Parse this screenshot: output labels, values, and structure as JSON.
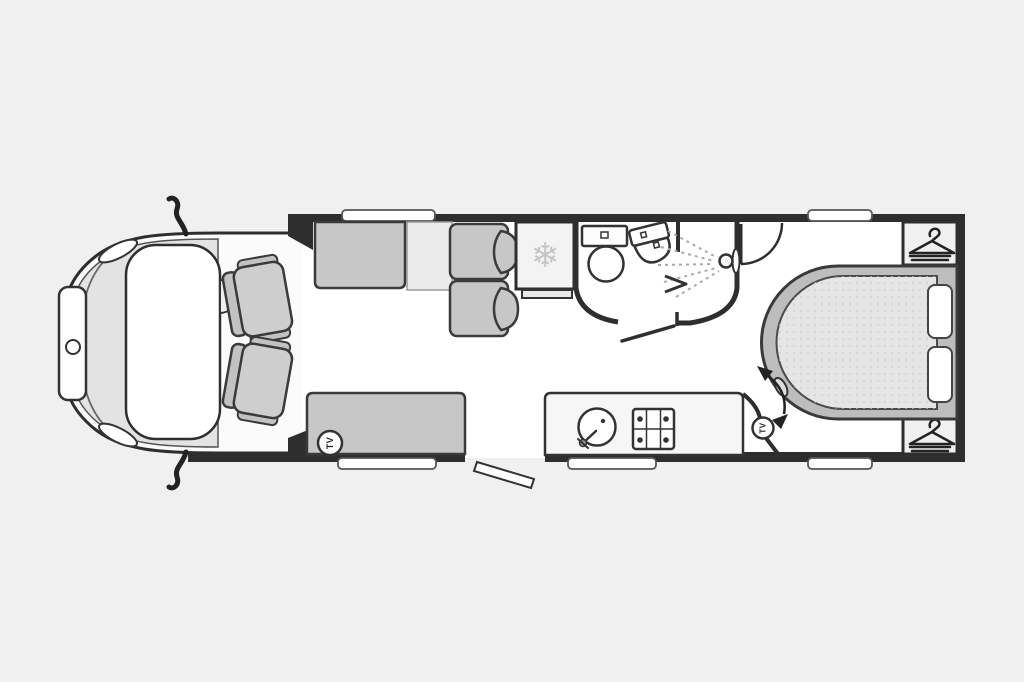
{
  "page": {
    "background_color": "#f0f0f0"
  },
  "floorplan": {
    "kind": "motorhome-floorplan",
    "front_tv_label": "TV",
    "rear_tv_label": "TV",
    "fridge_icon": "❄",
    "icons": {
      "fridge": "snowflake-icon",
      "wardrobe": "hanger-icon",
      "shower": "shower-head-icon",
      "tv": "tv-badge"
    },
    "colors": {
      "background": "#f0f0f0",
      "floor": "#ffffff",
      "wall": "#2e2e2e",
      "furniture": "#c7c7c7",
      "bed_base": "#bdbdbd",
      "mattress": "#e5e5e5",
      "fixture": "#ffffff"
    }
  }
}
